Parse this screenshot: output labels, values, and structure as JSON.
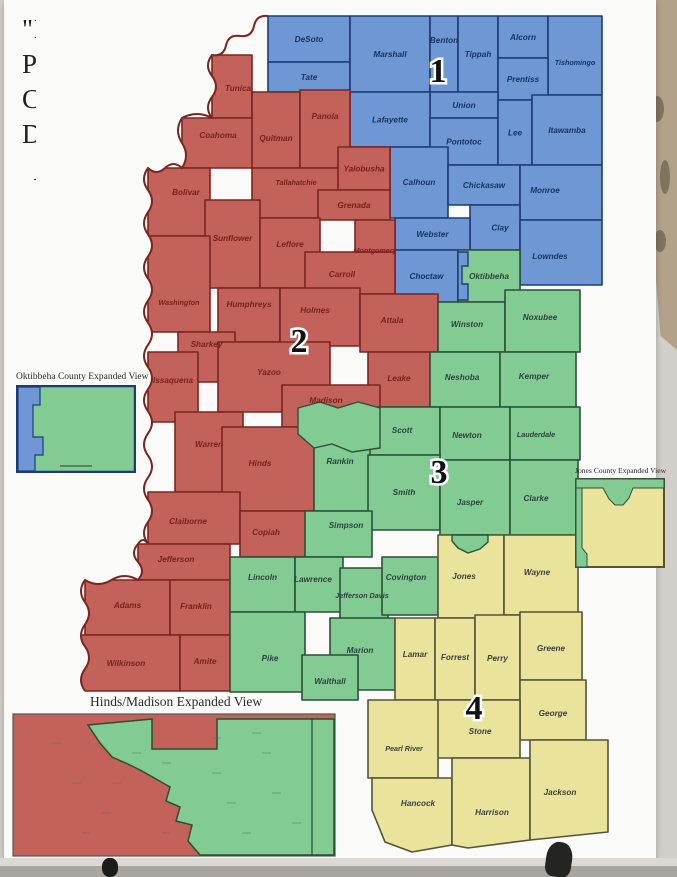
{
  "photo": {
    "background_color": "#d2cfca",
    "wall_color": "#b2a289",
    "poster_color": "#fafaf8"
  },
  "poster": {
    "title_lines": [
      "\"Magnolia1\"",
      "Proposed",
      "Congressional",
      "Districts"
    ],
    "north_arrow_letter": "N"
  },
  "map": {
    "river_border_color": "#7c2420",
    "districts": [
      {
        "id": 1,
        "number": "1",
        "fill": "#6e97d3",
        "border": "#1d3c77",
        "text_color": "#163467",
        "number_x": 438,
        "number_y": 82
      },
      {
        "id": 2,
        "number": "2",
        "fill": "#c2625a",
        "border": "#7c2420",
        "text_color": "#7a211c",
        "number_x": 299,
        "number_y": 352
      },
      {
        "id": 3,
        "number": "3",
        "fill": "#82cb93",
        "border": "#2b513a",
        "text_color": "#2e423f",
        "number_x": 439,
        "number_y": 483
      },
      {
        "id": 4,
        "number": "4",
        "fill": "#e9e39b",
        "border": "#55533a",
        "text_color": "#3c403d",
        "number_x": 474,
        "number_y": 719
      }
    ],
    "counties": [
      {
        "name": "DeSoto",
        "district": 1,
        "rect": [
          268,
          16,
          82,
          46
        ]
      },
      {
        "name": "Tate",
        "district": 1,
        "rect": [
          268,
          62,
          82,
          30
        ]
      },
      {
        "name": "Marshall",
        "district": 1,
        "rect": [
          350,
          16,
          80,
          76
        ]
      },
      {
        "name": "Benton",
        "district": 1,
        "rect": [
          430,
          16,
          28,
          76
        ],
        "ly": 40
      },
      {
        "name": "Tippah",
        "district": 1,
        "rect": [
          458,
          16,
          40,
          76
        ]
      },
      {
        "name": "Alcorn",
        "district": 1,
        "rect": [
          498,
          16,
          50,
          42
        ]
      },
      {
        "name": "Tishomingo",
        "district": 1,
        "rect": [
          548,
          16,
          54,
          79
        ],
        "ly": 62
      },
      {
        "name": "Prentiss",
        "district": 1,
        "rect": [
          498,
          58,
          50,
          42
        ]
      },
      {
        "name": "Union",
        "district": 1,
        "rect": [
          430,
          92,
          68,
          26
        ]
      },
      {
        "name": "Lafayette",
        "district": 1,
        "rect": [
          350,
          92,
          80,
          55
        ]
      },
      {
        "name": "Pontotoc",
        "district": 1,
        "rect": [
          430,
          118,
          68,
          47
        ]
      },
      {
        "name": "Lee",
        "district": 1,
        "rect": [
          498,
          100,
          34,
          65
        ]
      },
      {
        "name": "Itawamba",
        "district": 1,
        "rect": [
          532,
          95,
          70,
          70
        ]
      },
      {
        "name": "Calhoun",
        "district": 1,
        "rect": [
          390,
          147,
          58,
          71
        ],
        "ly": 182
      },
      {
        "name": "Chickasaw",
        "district": 1,
        "rect": [
          448,
          165,
          72,
          40
        ]
      },
      {
        "name": "Monroe",
        "district": 1,
        "rect": [
          520,
          165,
          82,
          55
        ],
        "lx": 545,
        "ly": 190
      },
      {
        "name": "Clay",
        "district": 1,
        "rect": [
          470,
          205,
          50,
          45
        ],
        "lx": 500
      },
      {
        "name": "Webster",
        "district": 1,
        "rect": [
          395,
          218,
          75,
          32
        ]
      },
      {
        "name": "Lowndes",
        "district": 1,
        "rect": [
          520,
          220,
          82,
          65
        ],
        "lx": 550,
        "ly": 256
      },
      {
        "name": "Choctaw",
        "district": 1,
        "rect": [
          395,
          250,
          63,
          52
        ]
      },
      {
        "name": "Tunica",
        "district": 2,
        "rect": [
          212,
          55,
          40,
          63
        ],
        "lx": 238,
        "ly": 88
      },
      {
        "name": "Coahoma",
        "district": 2,
        "rect": [
          182,
          118,
          72,
          50
        ],
        "ly": 135
      },
      {
        "name": "Quitman",
        "district": 2,
        "rect": [
          252,
          92,
          48,
          76
        ],
        "ly": 138
      },
      {
        "name": "Panola",
        "district": 2,
        "rect": [
          300,
          90,
          50,
          78
        ],
        "ly": 116
      },
      {
        "name": "Tallahatchie",
        "district": 2,
        "rect": [
          252,
          168,
          88,
          50
        ],
        "ly": 182
      },
      {
        "name": "Yalobusha",
        "district": 2,
        "rect": [
          338,
          147,
          52,
          43
        ]
      },
      {
        "name": "Grenada",
        "district": 2,
        "rect": [
          318,
          190,
          72,
          30
        ]
      },
      {
        "name": "Bolivar",
        "district": 2,
        "rect": [
          148,
          168,
          62,
          68
        ],
        "lx": 186,
        "ly": 192
      },
      {
        "name": "Sunflower",
        "district": 2,
        "rect": [
          205,
          200,
          55,
          88
        ],
        "ly": 238
      },
      {
        "name": "Leflore",
        "district": 2,
        "rect": [
          260,
          218,
          60,
          70
        ],
        "ly": 244
      },
      {
        "name": "Montgomery",
        "district": 2,
        "rect": [
          355,
          220,
          40,
          48
        ],
        "ly": 250
      },
      {
        "name": "Carroll",
        "district": 2,
        "rect": [
          305,
          252,
          90,
          42
        ],
        "lx": 342,
        "ly": 274
      },
      {
        "name": "Washington",
        "district": 2,
        "rect": [
          148,
          236,
          62,
          96
        ],
        "ly": 302
      },
      {
        "name": "Humphreys",
        "district": 2,
        "rect": [
          218,
          288,
          62,
          54
        ],
        "ly": 304
      },
      {
        "name": "Holmes",
        "district": 2,
        "rect": [
          280,
          288,
          80,
          58
        ],
        "lx": 315,
        "ly": 310
      },
      {
        "name": "Attala",
        "district": 2,
        "rect": [
          360,
          294,
          78,
          58
        ],
        "lx": 392,
        "ly": 320
      },
      {
        "name": "Sharkey",
        "district": 2,
        "rect": [
          178,
          332,
          57,
          50
        ],
        "ly": 344
      },
      {
        "name": "Issaquena",
        "district": 2,
        "rect": [
          148,
          352,
          50,
          70
        ],
        "ly": 380
      },
      {
        "name": "Yazoo",
        "district": 2,
        "rect": [
          218,
          342,
          112,
          70
        ],
        "lx": 269,
        "ly": 372
      },
      {
        "name": "Leake",
        "district": 2,
        "rect": [
          368,
          352,
          62,
          55
        ],
        "ly": 378
      },
      {
        "name": "Madison",
        "district": 2,
        "rect": [
          282,
          385,
          98,
          42
        ],
        "lx": 326,
        "ly": 400
      },
      {
        "name": "Warren",
        "district": 2,
        "rect": [
          175,
          412,
          68,
          80
        ],
        "ly": 444
      },
      {
        "name": "Hinds",
        "district": 2,
        "rect": [
          222,
          427,
          92,
          84
        ],
        "lx": 260,
        "ly": 463
      },
      {
        "name": "Claiborne",
        "district": 2,
        "rect": [
          148,
          492,
          92,
          52
        ],
        "lx": 188,
        "ly": 521
      },
      {
        "name": "Copiah",
        "district": 2,
        "rect": [
          240,
          511,
          70,
          46
        ],
        "lx": 266,
        "ly": 532
      },
      {
        "name": "Jefferson",
        "district": 2,
        "rect": [
          138,
          544,
          92,
          36
        ],
        "lx": 176,
        "ly": 559
      },
      {
        "name": "Adams",
        "district": 2,
        "rect": [
          85,
          580,
          85,
          55
        ],
        "ly": 605
      },
      {
        "name": "Franklin",
        "district": 2,
        "rect": [
          170,
          580,
          60,
          55
        ],
        "lx": 196,
        "ly": 606
      },
      {
        "name": "Wilkinson",
        "district": 2,
        "rect": [
          80,
          635,
          100,
          56
        ],
        "lx": 126,
        "ly": 663
      },
      {
        "name": "Amite",
        "district": 2,
        "rect": [
          180,
          635,
          50,
          56
        ],
        "ly": 661
      },
      {
        "name": "Oktibbeha",
        "district": 3,
        "rect": [
          458,
          250,
          62,
          52
        ]
      },
      {
        "name": "Winston",
        "district": 3,
        "rect": [
          438,
          302,
          67,
          50
        ],
        "lx": 467,
        "ly": 324
      },
      {
        "name": "Noxubee",
        "district": 3,
        "rect": [
          505,
          290,
          75,
          62
        ],
        "lx": 540,
        "ly": 317
      },
      {
        "name": "Neshoba",
        "district": 3,
        "rect": [
          430,
          352,
          70,
          55
        ],
        "lx": 462,
        "ly": 377
      },
      {
        "name": "Kemper",
        "district": 3,
        "rect": [
          500,
          352,
          76,
          55
        ],
        "lx": 534,
        "ly": 376
      },
      {
        "name": "Scott",
        "district": 3,
        "rect": [
          368,
          407,
          72,
          48
        ],
        "lx": 402,
        "ly": 430
      },
      {
        "name": "Newton",
        "district": 3,
        "rect": [
          440,
          407,
          70,
          53
        ],
        "lx": 467,
        "ly": 435
      },
      {
        "name": "Lauderdale",
        "district": 3,
        "rect": [
          510,
          407,
          70,
          53
        ],
        "lx": 536,
        "ly": 434
      },
      {
        "name": "Rankin",
        "district": 3,
        "rect": [
          314,
          427,
          56,
          84
        ],
        "lx": 340,
        "ly": 461
      },
      {
        "name": "Smith",
        "district": 3,
        "rect": [
          368,
          455,
          72,
          75
        ],
        "ly": 492
      },
      {
        "name": "Jasper",
        "district": 3,
        "rect": [
          440,
          460,
          70,
          75
        ],
        "lx": 470,
        "ly": 502
      },
      {
        "name": "Clarke",
        "district": 3,
        "rect": [
          510,
          460,
          68,
          75
        ],
        "lx": 536,
        "ly": 498
      },
      {
        "name": "Simpson",
        "district": 3,
        "rect": [
          305,
          511,
          67,
          46
        ],
        "lx": 346,
        "ly": 525
      },
      {
        "name": "Lincoln",
        "district": 3,
        "rect": [
          230,
          557,
          65,
          55
        ],
        "ly": 577
      },
      {
        "name": "Lawrence",
        "district": 3,
        "rect": [
          295,
          557,
          48,
          55
        ],
        "lx": 313,
        "ly": 579
      },
      {
        "name": "Jefferson Davis",
        "district": 3,
        "rect": [
          340,
          568,
          48,
          54
        ],
        "lx": 362,
        "ly": 595
      },
      {
        "name": "Covington",
        "district": 3,
        "rect": [
          382,
          557,
          56,
          58
        ],
        "lx": 406,
        "ly": 577
      },
      {
        "name": "Pike",
        "district": 3,
        "rect": [
          230,
          612,
          75,
          80
        ],
        "lx": 270,
        "ly": 658
      },
      {
        "name": "Marion",
        "district": 3,
        "rect": [
          330,
          618,
          65,
          72
        ],
        "lx": 360,
        "ly": 650
      },
      {
        "name": "Walthall",
        "district": 3,
        "rect": [
          302,
          655,
          56,
          45
        ],
        "ly": 681
      },
      {
        "name": "Jones",
        "district": 4,
        "rect": [
          438,
          535,
          66,
          83
        ],
        "lx": 464,
        "ly": 576
      },
      {
        "name": "Wayne",
        "district": 4,
        "rect": [
          504,
          535,
          74,
          80
        ],
        "lx": 537,
        "ly": 572
      },
      {
        "name": "Lamar",
        "district": 4,
        "rect": [
          395,
          618,
          40,
          82
        ],
        "ly": 654
      },
      {
        "name": "Forrest",
        "district": 4,
        "rect": [
          435,
          618,
          40,
          82
        ],
        "ly": 657
      },
      {
        "name": "Perry",
        "district": 4,
        "rect": [
          475,
          615,
          45,
          85
        ],
        "ly": 658
      },
      {
        "name": "Greene",
        "district": 4,
        "rect": [
          520,
          612,
          62,
          68
        ],
        "ly": 648
      },
      {
        "name": "George",
        "district": 4,
        "rect": [
          520,
          680,
          66,
          60
        ],
        "ly": 713
      },
      {
        "name": "Stone",
        "district": 4,
        "rect": [
          435,
          700,
          85,
          58
        ],
        "lx": 480,
        "ly": 731
      },
      {
        "name": "Pearl River",
        "district": 4,
        "rect": [
          368,
          700,
          70,
          78
        ],
        "lx": 404,
        "ly": 748
      },
      {
        "name": "Hancock",
        "district": 4,
        "poly": "372,778 452,778 452,845 412,852 385,842 372,810",
        "lx": 418,
        "ly": 803
      },
      {
        "name": "Harrison",
        "district": 4,
        "poly": "452,758 530,758 530,840 468,848 452,845",
        "lx": 492,
        "ly": 812
      },
      {
        "name": "Jackson",
        "district": 4,
        "poly": "530,740 608,740 608,832 530,840",
        "lx": 560,
        "ly": 792
      }
    ],
    "extra_shapes": [
      {
        "name": "madison-south-green-area",
        "district": 3,
        "points": "298,408 320,402 338,408 358,402 380,408 380,448 352,452 332,444 314,448 298,434"
      },
      {
        "name": "oktibbeha-west-blue-strip",
        "district": 1,
        "points": "458,252 468,252 468,266 462,266 462,284 468,284 468,300 458,300"
      },
      {
        "name": "jones-north-green-notch",
        "district": 3,
        "points": "452,535 488,535 488,542 480,549 468,553 458,548 452,541"
      }
    ]
  },
  "insets": {
    "oktibbeha": {
      "title": "Oktibbeha County Expanded View"
    },
    "jones": {
      "title": "Jones County Expanded View"
    },
    "hinds": {
      "title": "Hinds/Madison Expanded View"
    }
  }
}
